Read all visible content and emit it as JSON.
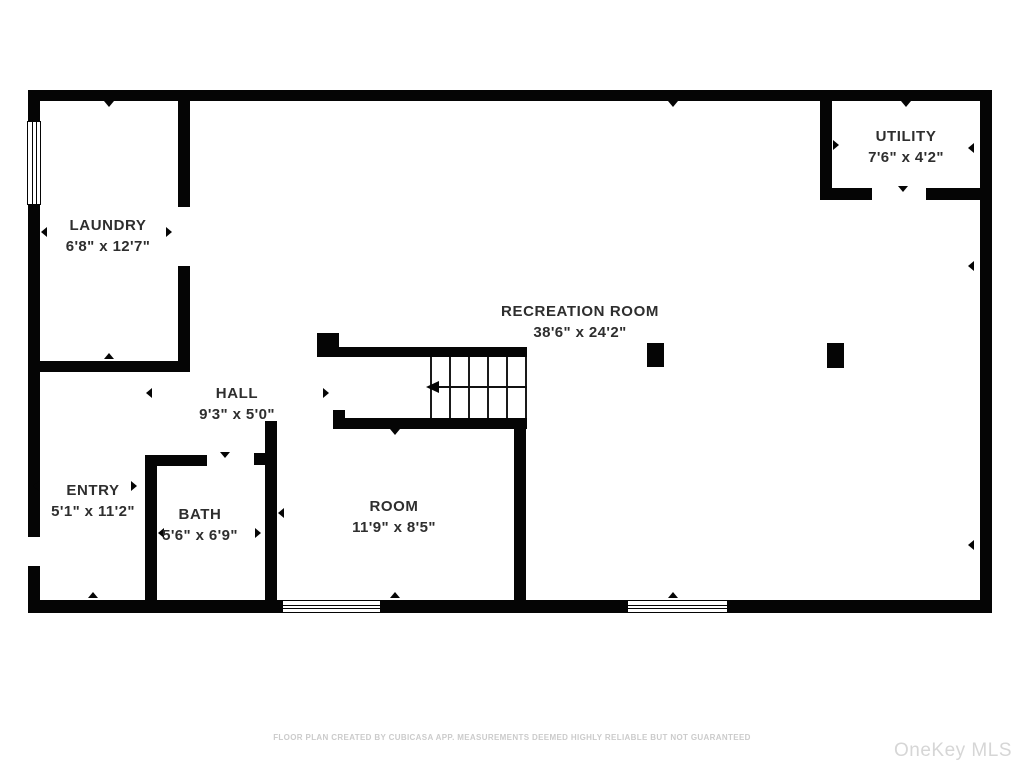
{
  "floor_plan": {
    "rooms": [
      {
        "name": "LAUNDRY",
        "dimensions": "6'8\" x 12'7\""
      },
      {
        "name": "UTILITY",
        "dimensions": "7'6\" x 4'2\""
      },
      {
        "name": "RECREATION ROOM",
        "dimensions": "38'6\" x 24'2\""
      },
      {
        "name": "HALL",
        "dimensions": "9'3\" x 5'0\""
      },
      {
        "name": "ENTRY",
        "dimensions": "5'1\" x 11'2\""
      },
      {
        "name": "BATH",
        "dimensions": "5'6\" x 6'9\""
      },
      {
        "name": "ROOM",
        "dimensions": "11'9\" x 8'5\""
      }
    ],
    "icons": {
      "stairs_arrow": "left-arrow"
    },
    "colors": {
      "wall": "#050505",
      "background": "#ffffff",
      "label_text": "#2e2e2e",
      "footer_text": "#cbcbcb",
      "watermark_text": "#d6d6d6"
    },
    "footer": "FLOOR PLAN CREATED BY CUBICASA APP. MEASUREMENTS DEEMED HIGHLY RELIABLE BUT NOT GUARANTEED",
    "watermark": "OneKey MLS"
  }
}
